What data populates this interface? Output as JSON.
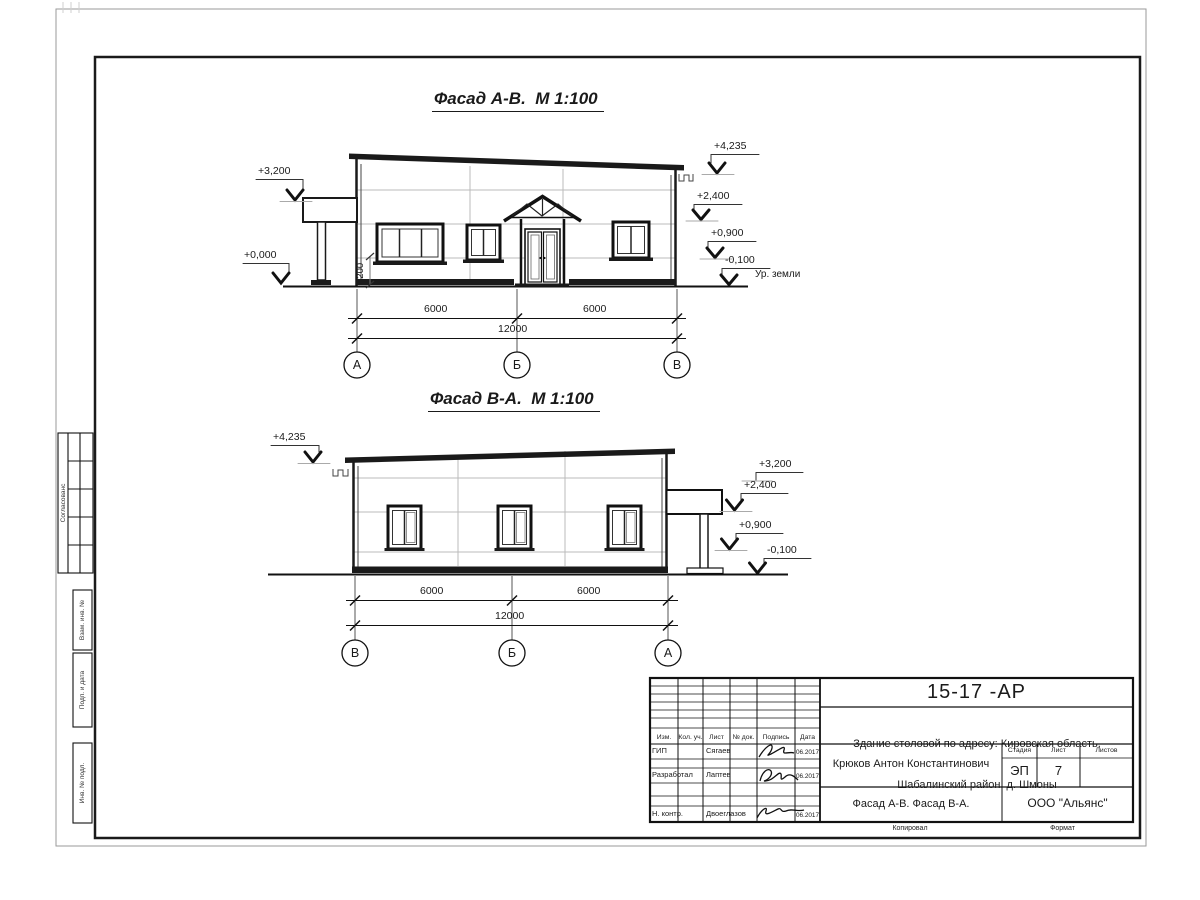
{
  "colors": {
    "ink": "#1a1a1a",
    "faint_line": "#bbbbbb"
  },
  "sheet": {
    "facade1": {
      "title": "Фасад А-В.  М 1:100",
      "elev_left_top": "+3,200",
      "elev_left_bottom": "+0,000",
      "elev_right_1": "+4,235",
      "elev_right_2": "+2,400",
      "elev_right_3": "+0,900",
      "elev_right_4": "-0,100",
      "ground_label": "Ур. земли",
      "sill_dim": "1200",
      "dim_left": "6000",
      "dim_right": "6000",
      "dim_total": "12000",
      "axis_left": "А",
      "axis_mid": "Б",
      "axis_right": "В"
    },
    "facade2": {
      "title": "Фасад В-А.  М 1:100",
      "elev_left_top": "+4,235",
      "elev_right_1": "+3,200",
      "elev_right_2": "+2,400",
      "elev_right_3": "+0,900",
      "elev_right_4": "-0,100",
      "dim_left": "6000",
      "dim_right": "6000",
      "dim_total": "12000",
      "axis_left": "В",
      "axis_mid": "Б",
      "axis_right": "А"
    },
    "titleblock": {
      "doc_number": "15-17 -АР",
      "project_line1": "Здание столовой по адресу: Кировская область,",
      "project_line2": "Шабалинский район, д. Шмоны",
      "author": "Крюков Антон Константинович",
      "sheet_title": "Фасад А-В. Фасад В-А.",
      "company": "ООО \"Альянс\"",
      "stage_label": "Стадия",
      "sheet_label": "Лист",
      "sheets_label": "Листов",
      "stage_value": "ЭП",
      "sheet_value": "7",
      "columns": [
        "Изм.",
        "Кол. уч.",
        "Лист",
        "№ док.",
        "Подпись",
        "Дата"
      ],
      "rows": [
        {
          "role": "ГИП",
          "name": "Сягаев",
          "date": "06.2017"
        },
        {
          "role": "Разработал",
          "name": "Лаптев",
          "date": "06.2017"
        },
        {
          "role": "Н. контр.",
          "name": "Двоеглазов",
          "date": "06.2017"
        }
      ],
      "footer_copy": "Копировал",
      "footer_format": "Формат"
    },
    "margin_stamps": {
      "agreed": "Согласованс",
      "vzam": "Взам. инв. №",
      "podp": "Подп. и дата",
      "inv": "Инв. № подл."
    }
  }
}
